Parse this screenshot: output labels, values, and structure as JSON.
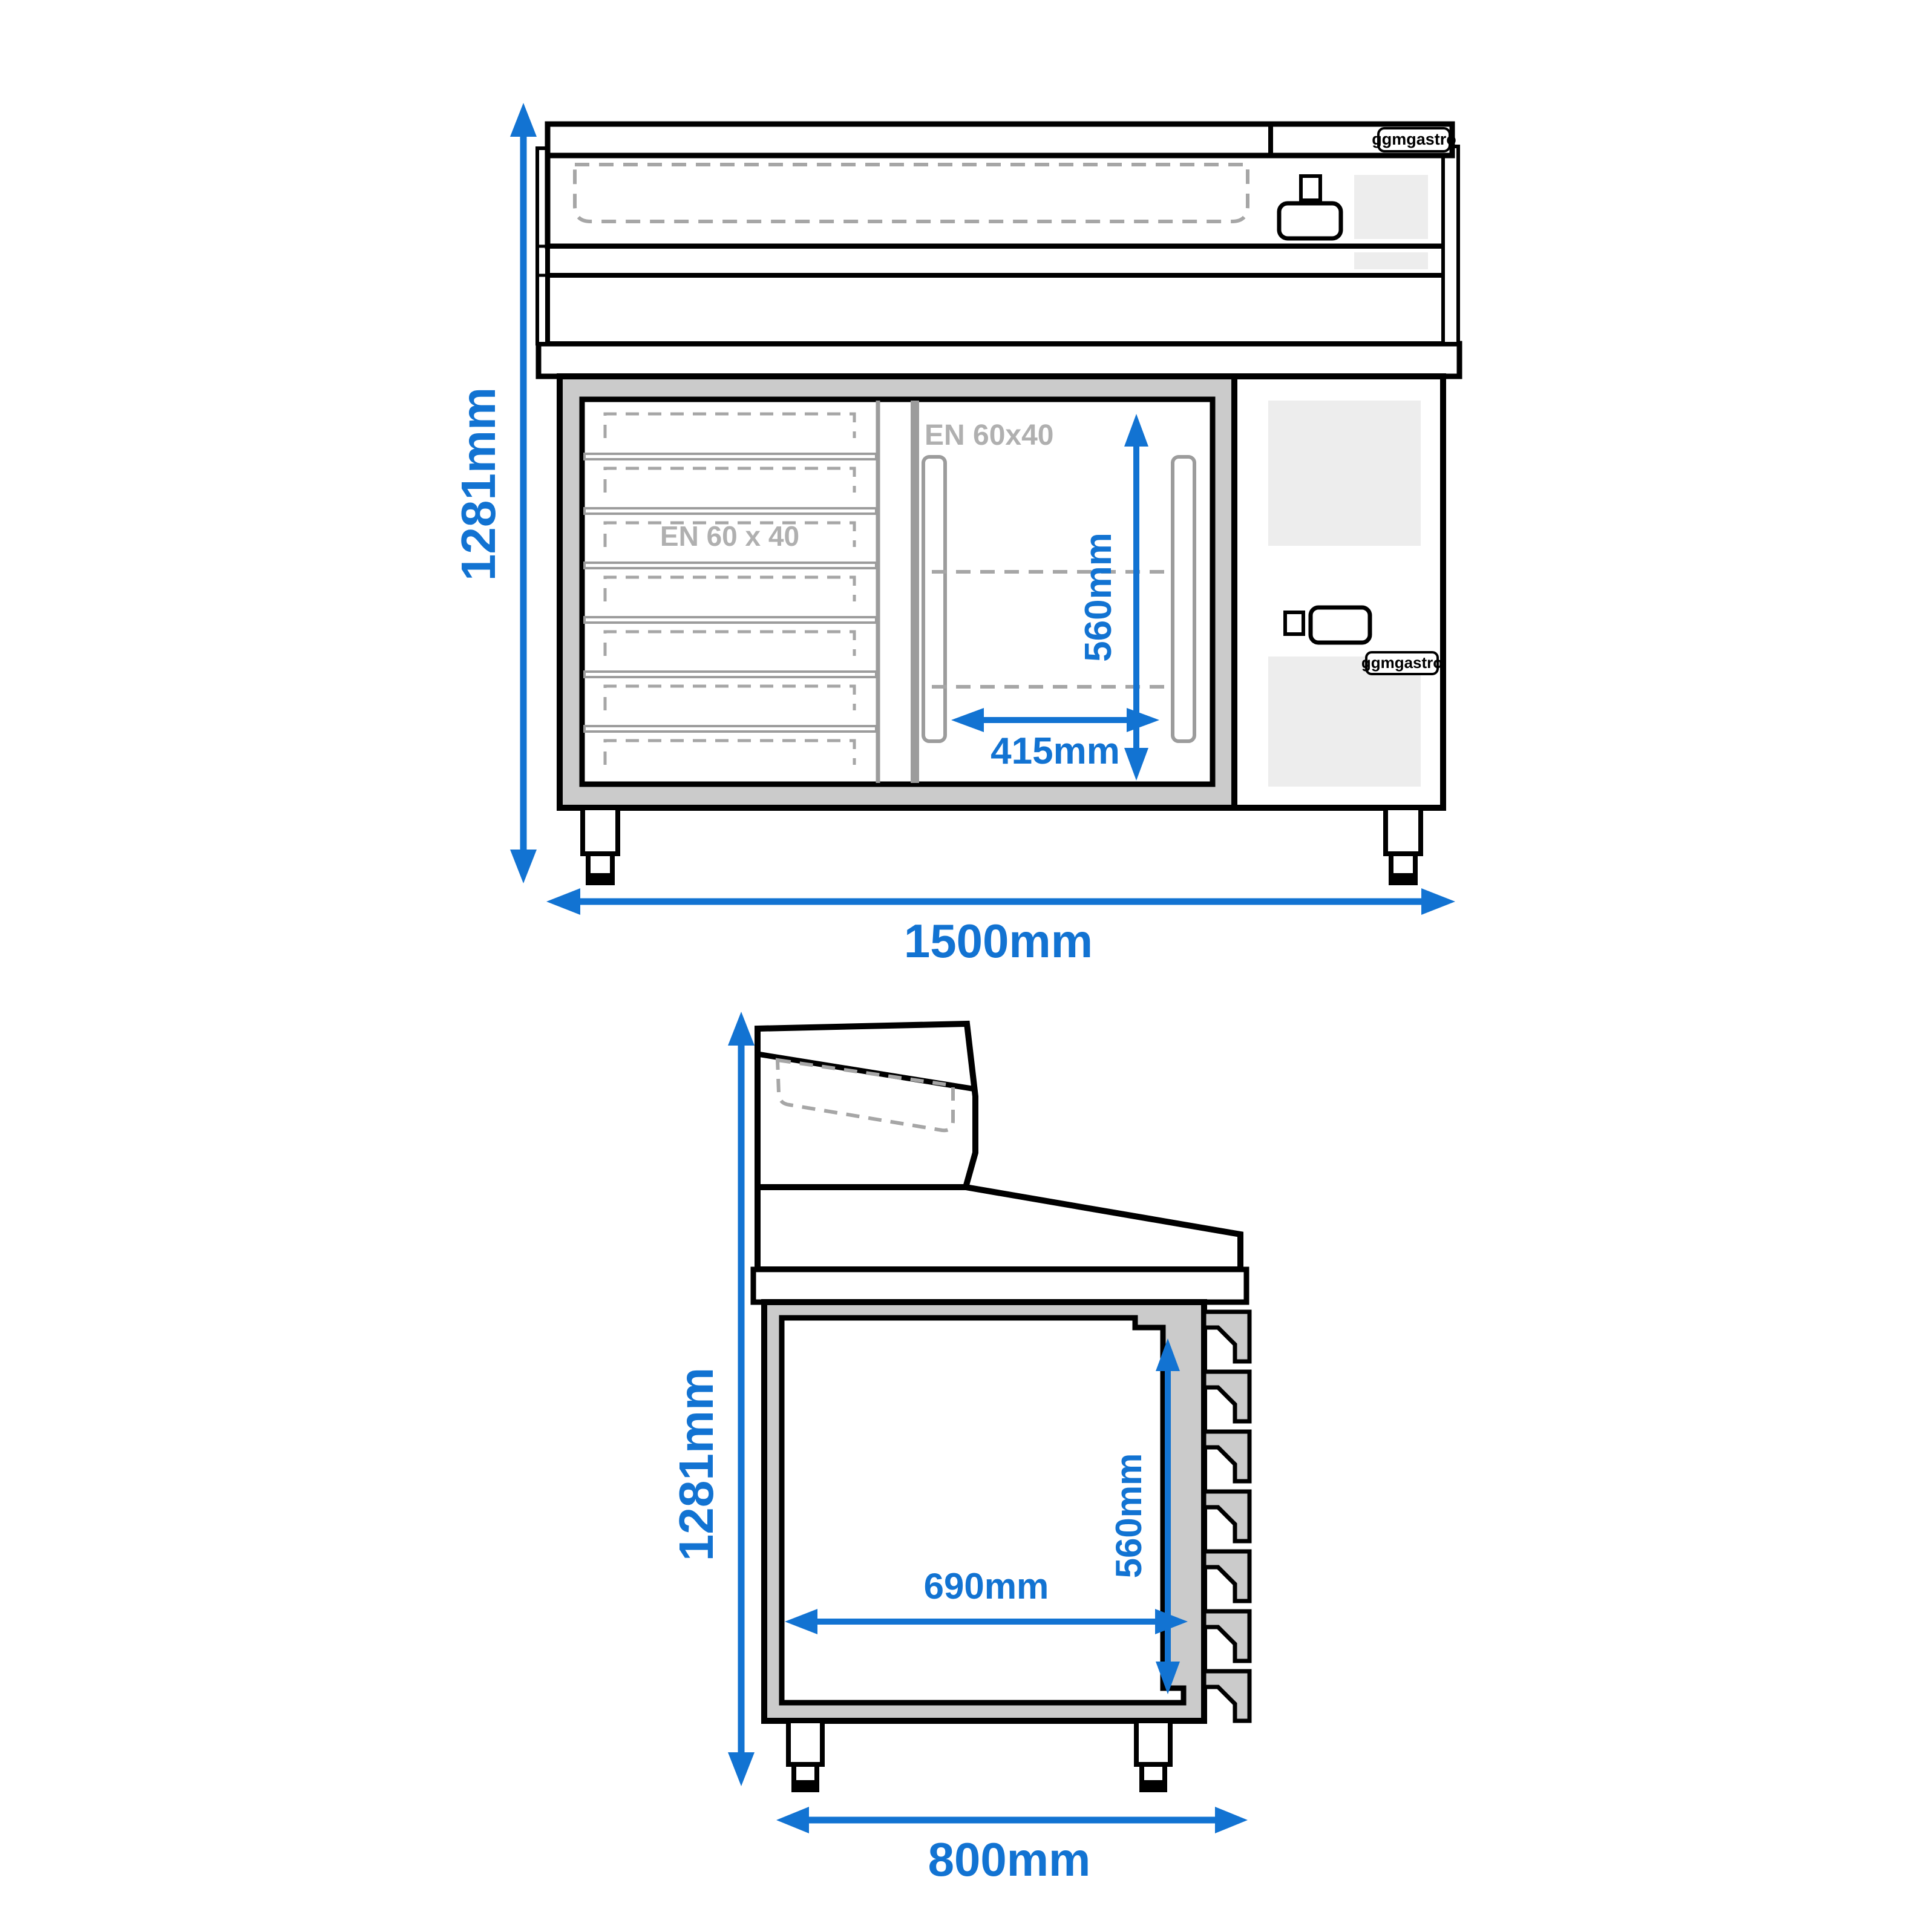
{
  "front_view": {
    "height_label": "1281mm",
    "width_label": "1500mm",
    "compartment_height_label": "560mm",
    "compartment_width_label": "415mm",
    "drawer_area_label": "EN 60 x 40",
    "compartment_area_label": "EN 60x40",
    "logo_top_label": "ggmgastro",
    "logo_panel_label": "ggmgastro"
  },
  "side_view": {
    "height_label": "1281mm",
    "width_label": "800mm",
    "interior_height_label": "560mm",
    "interior_width_label": "690mm"
  },
  "colors": {
    "dimension_blue": "#1273d2",
    "outline_black": "#000000",
    "body_gray": "#cbcbcb",
    "vent_gray": "#ededed",
    "dash_gray": "#a6a6a6",
    "divider_gray": "#9c9c9c",
    "ghost_text_gray": "#b0b0b0"
  }
}
